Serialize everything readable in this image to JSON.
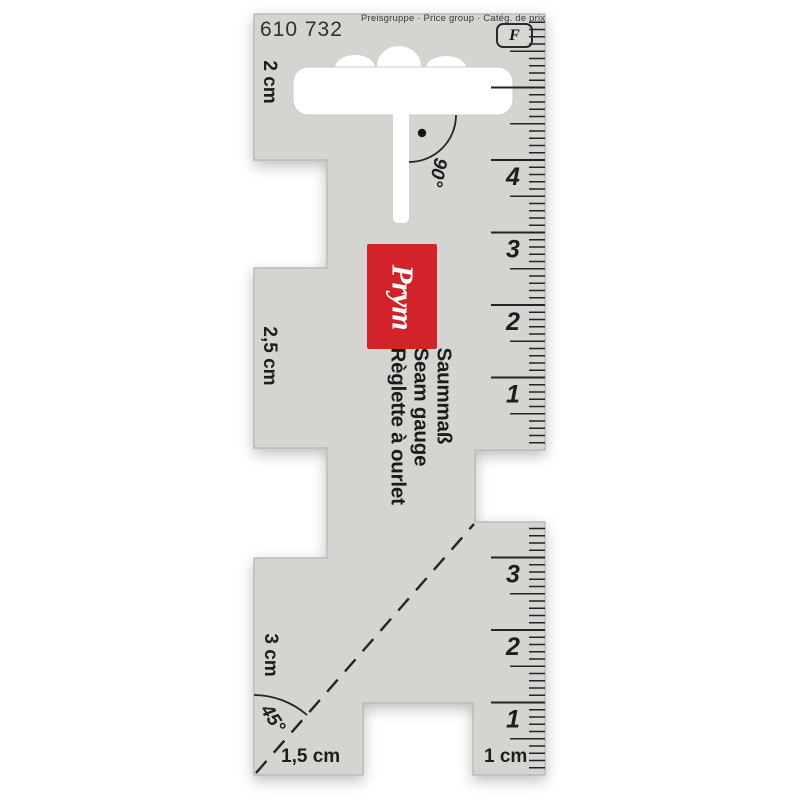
{
  "product": {
    "article_number": "610 732",
    "price_group_label": "Preisgruppe · Price group · Catég. de prix",
    "price_group_value": "F",
    "brand": "Prym",
    "name_de": "Saummaß",
    "name_en": "Seam gauge",
    "name_fr": "Règlette à ourlet"
  },
  "markings": {
    "left_top": "2 cm",
    "left_middle": "2,5 cm",
    "left_bottom": "3 cm",
    "bottom_left": "1,5 cm",
    "bottom_right": "1 cm",
    "angle_top": "90°",
    "angle_bottom": "45°"
  },
  "rulers": {
    "top_right": {
      "unit": "cm",
      "labels": [
        "1",
        "2",
        "3",
        "4"
      ]
    },
    "bottom_right": {
      "unit": "cm",
      "labels": [
        "1",
        "2",
        "3"
      ]
    }
  },
  "colors": {
    "body_gray": "#d5d4d1",
    "brand_red": "#d2232a",
    "ink": "#232323",
    "background": "#ffffff"
  }
}
